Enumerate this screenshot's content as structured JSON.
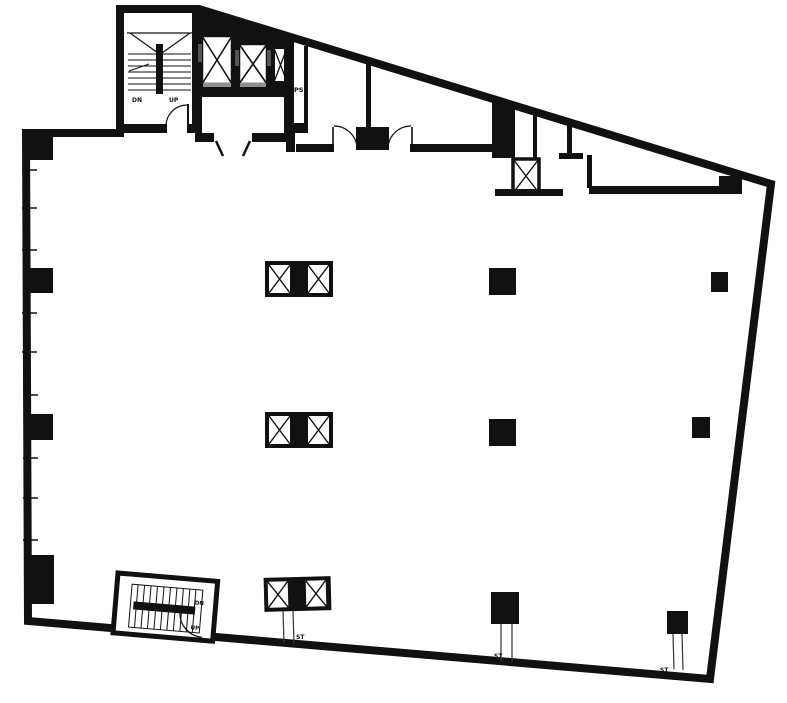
{
  "drawing": {
    "type": "architectural-floor-plan",
    "colors": {
      "ink": "#111111",
      "paper": "#ffffff",
      "sill": "#8f8f8f",
      "riser": "#333333"
    },
    "labels": {
      "stairwell_top": {
        "down": "DN",
        "up": "UP"
      },
      "stairwell_bottom": {
        "down": "DN",
        "up": "UP"
      },
      "pipe_shaft": "PS",
      "standpipes": [
        "ST",
        "ST",
        "ST"
      ]
    },
    "features": {
      "elevator_shafts": 3,
      "stairwells": 2,
      "column_rows": 3,
      "shaft_clusters": 3
    }
  }
}
